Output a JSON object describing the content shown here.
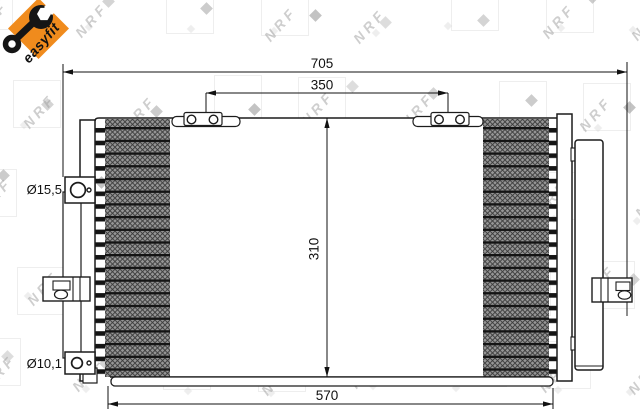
{
  "badge": {
    "label": "easyfit",
    "icon": "wrench-icon",
    "color": "#f08b1d"
  },
  "watermark": {
    "text": "NRF"
  },
  "dims": {
    "overall_width": "705",
    "mounting_span": "350",
    "core_height": "310",
    "core_width": "570",
    "top_port": "Ø15,5",
    "bottom_port": "Ø10,1"
  },
  "colors": {
    "accent_orange": "#f08b1d",
    "line": "#1c1c1c",
    "watermark_gray": "#9b9b9b"
  }
}
